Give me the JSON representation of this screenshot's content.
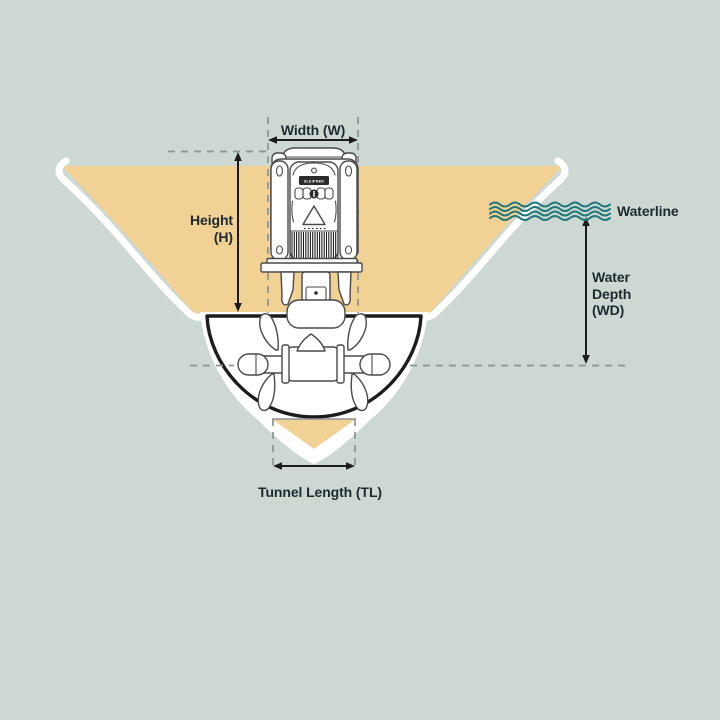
{
  "diagram": {
    "labels": {
      "width": "Width (W)",
      "height_line1": "Height",
      "height_line2": "(H)",
      "waterline": "Waterline",
      "water_depth_line1": "Water",
      "water_depth_line2": "Depth",
      "water_depth_line3": "(WD)",
      "tunnel_length": "Tunnel Length (TL)",
      "brand": "SLEIPNER"
    },
    "colors": {
      "background": "#cdd8d3",
      "hull_fill": "#f2d194",
      "hull_edge": "#ffffff",
      "line_art": "#4a4a4a",
      "outline_black": "#1c1c1c",
      "wave_teal": "#20787a",
      "text": "#1e2831",
      "dash_gray": "#8a9492"
    }
  }
}
